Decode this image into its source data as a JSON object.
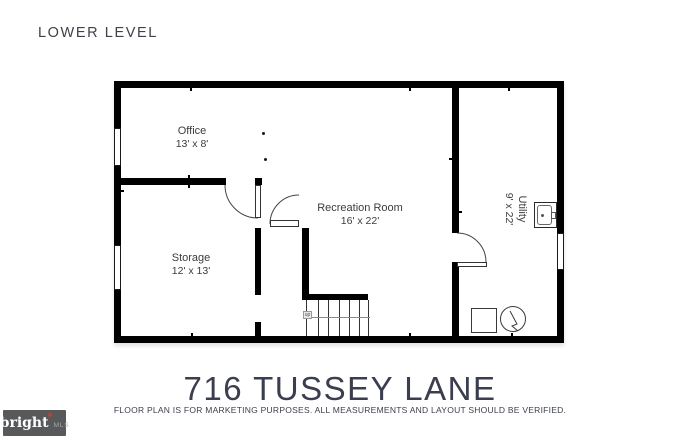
{
  "page": {
    "level_label": "LOWER LEVEL",
    "title": "716 TUSSEY LANE",
    "disclaimer": "FLOOR PLAN IS FOR MARKETING PURPOSES. ALL MEASUREMENTS AND LAYOUT SHOULD BE VERIFIED."
  },
  "floor_plan": {
    "rooms": [
      {
        "name": "Office",
        "dimensions": "13' x 8'"
      },
      {
        "name": "Storage",
        "dimensions": "12' x 13'"
      },
      {
        "name": "Recreation Room",
        "dimensions": "16' x 22'"
      },
      {
        "name": "Utility",
        "dimensions": "9' x 22'"
      }
    ],
    "stairs_label": "up",
    "icons": [
      "door-arc-icon",
      "window-icon",
      "stairs-icon",
      "sink-icon",
      "water-heater-icon",
      "hvac-unit-icon"
    ]
  },
  "branding": {
    "logo_text": "bright",
    "logo_suffix": "MLS",
    "logo_bg": "#58595b",
    "logo_spark_color": "#c5402f"
  },
  "colors": {
    "wall": "#000000",
    "label_text": "#3c3c3c",
    "title_text": "#3a3e4e"
  }
}
